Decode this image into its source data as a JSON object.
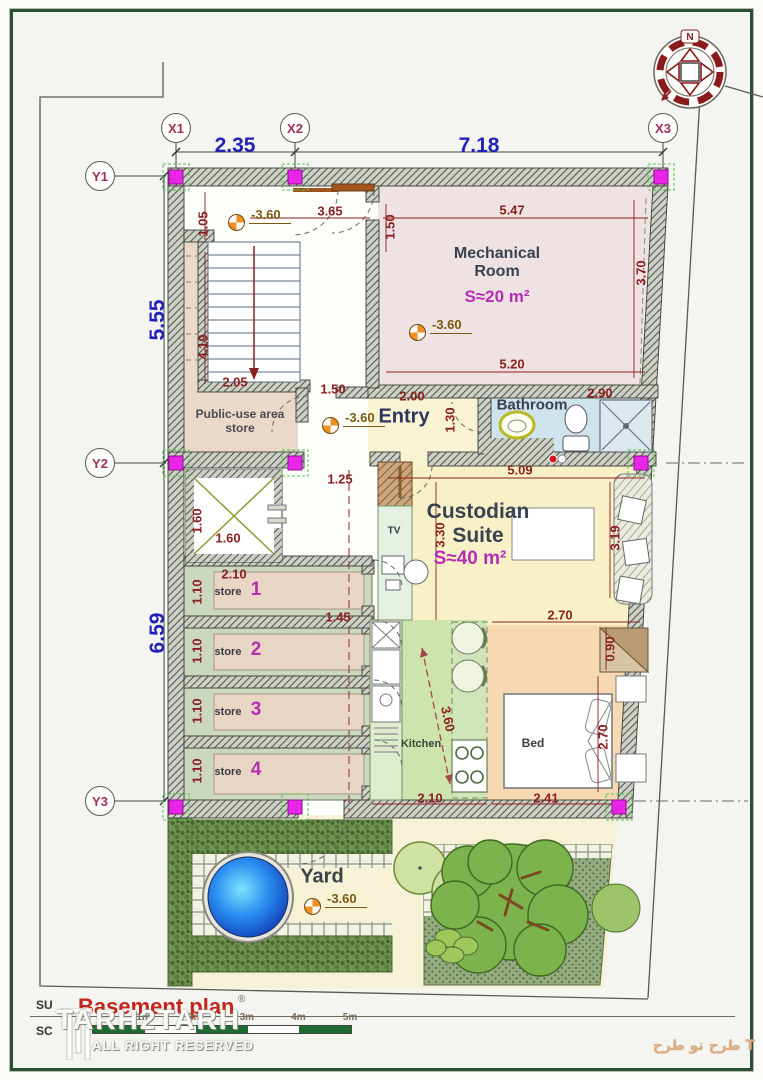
{
  "accent_colors": {
    "wall_hatch": "#4e5248",
    "column_magenta": "#ea25ea",
    "dim_red": "#8b2020",
    "dim_blue": "#2222b8",
    "area_magenta": "#b52cb5",
    "title_red": "#c2251c",
    "pool_blue": "#1560e8",
    "lawn_green": "#93ab7e"
  },
  "compass": {
    "north_label": "N"
  },
  "grid_bubbles": [
    {
      "label": "X1",
      "x": 176,
      "y": 128
    },
    {
      "label": "X2",
      "x": 295,
      "y": 128
    },
    {
      "label": "X3",
      "x": 663,
      "y": 128
    },
    {
      "label": "Y1",
      "x": 100,
      "y": 176
    },
    {
      "label": "Y2",
      "x": 100,
      "y": 463
    },
    {
      "label": "Y3",
      "x": 100,
      "y": 801
    }
  ],
  "blue_dims": [
    {
      "text": "2.35",
      "x": 235,
      "y": 146,
      "rot": 0
    },
    {
      "text": "7.18",
      "x": 479,
      "y": 146,
      "rot": 0
    },
    {
      "text": "5.55",
      "x": 158,
      "y": 320,
      "rot": -90
    },
    {
      "text": "6.59",
      "x": 158,
      "y": 633,
      "rot": -90
    }
  ],
  "red_dims": [
    {
      "text": "1.05",
      "x": 203,
      "y": 224,
      "rot": -90
    },
    {
      "text": "3.65",
      "x": 330,
      "y": 211,
      "rot": 0
    },
    {
      "text": "5.47",
      "x": 512,
      "y": 210,
      "rot": 0
    },
    {
      "text": "1.50",
      "x": 390,
      "y": 227,
      "rot": -90
    },
    {
      "text": "3.70",
      "x": 641,
      "y": 273,
      "rot": -90
    },
    {
      "text": "4.19",
      "x": 203,
      "y": 347,
      "rot": -90
    },
    {
      "text": "2.05",
      "x": 235,
      "y": 382,
      "rot": 0
    },
    {
      "text": "1.50",
      "x": 333,
      "y": 389,
      "rot": 0
    },
    {
      "text": "5.20",
      "x": 512,
      "y": 364,
      "rot": 0
    },
    {
      "text": "2.00",
      "x": 412,
      "y": 396,
      "rot": 0
    },
    {
      "text": "2.90",
      "x": 600,
      "y": 393,
      "rot": 0
    },
    {
      "text": "1.30",
      "x": 450,
      "y": 420,
      "rot": -90
    },
    {
      "text": "5.09",
      "x": 520,
      "y": 470,
      "rot": 0
    },
    {
      "text": "1.25",
      "x": 340,
      "y": 479,
      "rot": 0
    },
    {
      "text": "1.60",
      "x": 197,
      "y": 521,
      "rot": -90
    },
    {
      "text": "1.60",
      "x": 228,
      "y": 538,
      "rot": 0
    },
    {
      "text": "3.30",
      "x": 440,
      "y": 535,
      "rot": -90
    },
    {
      "text": "3.19",
      "x": 615,
      "y": 538,
      "rot": -90
    },
    {
      "text": "2.10",
      "x": 234,
      "y": 574,
      "rot": 0
    },
    {
      "text": "1.10",
      "x": 197,
      "y": 592,
      "rot": -90
    },
    {
      "text": "1.45",
      "x": 338,
      "y": 617,
      "rot": 0
    },
    {
      "text": "1.10",
      "x": 197,
      "y": 651,
      "rot": -90
    },
    {
      "text": "1.10",
      "x": 197,
      "y": 711,
      "rot": -90
    },
    {
      "text": "1.10",
      "x": 197,
      "y": 771,
      "rot": -90
    },
    {
      "text": "2.70",
      "x": 560,
      "y": 615,
      "rot": 0
    },
    {
      "text": "0.90",
      "x": 610,
      "y": 649,
      "rot": -90
    },
    {
      "text": "3.60",
      "x": 448,
      "y": 719,
      "rot": 78
    },
    {
      "text": "2.70",
      "x": 603,
      "y": 737,
      "rot": -90
    },
    {
      "text": "2.10",
      "x": 430,
      "y": 798,
      "rot": 0
    },
    {
      "text": "2.41",
      "x": 546,
      "y": 798,
      "rot": 0
    }
  ],
  "level_markers": [
    {
      "text": "-3.60",
      "x": 237,
      "y": 223
    },
    {
      "text": "-3.60",
      "x": 331,
      "y": 426
    },
    {
      "text": "-3.60",
      "x": 418,
      "y": 333
    },
    {
      "text": "-3.60",
      "x": 313,
      "y": 907
    }
  ],
  "room_labels": [
    {
      "id": "mechanical-room-label",
      "text": "Mechanical\nRoom",
      "x": 497,
      "y": 263,
      "size": 16,
      "color": "#3a4152",
      "weight": 700,
      "rot": 0
    },
    {
      "id": "mechanical-room-area",
      "text": "S≈20 m²",
      "x": 497,
      "y": 297,
      "size": 17,
      "color": "#b52cb5",
      "weight": 700,
      "rot": 0
    },
    {
      "id": "entry-label",
      "text": "Entry",
      "x": 404,
      "y": 417,
      "size": 20,
      "color": "#2c3660",
      "weight": 700,
      "rot": 0
    },
    {
      "id": "bathroom-label",
      "text": "Bathroom",
      "x": 532,
      "y": 405,
      "size": 15,
      "color": "#3a4152",
      "weight": 700,
      "rot": 0
    },
    {
      "id": "custodian-suite-label",
      "text": "Custodian\nSuite",
      "x": 478,
      "y": 524,
      "size": 21,
      "color": "#3a4152",
      "weight": 700,
      "rot": 0
    },
    {
      "id": "custodian-suite-area",
      "text": "S≈40 m²",
      "x": 470,
      "y": 559,
      "size": 19,
      "color": "#b52cb5",
      "weight": 700,
      "rot": 0
    },
    {
      "id": "public-store-label",
      "text": "Public-use area\nstore",
      "x": 240,
      "y": 421,
      "size": 12,
      "color": "#4a4a55",
      "weight": 700,
      "rot": 0
    },
    {
      "id": "store-1-label",
      "text": "store",
      "x": 228,
      "y": 592,
      "size": 11,
      "color": "#3a3a46",
      "weight": 700,
      "rot": 0
    },
    {
      "id": "store-1-num",
      "text": "1",
      "x": 256,
      "y": 590,
      "size": 19,
      "color": "#b030b0",
      "weight": 700,
      "rot": 0
    },
    {
      "id": "store-2-label",
      "text": "store",
      "x": 228,
      "y": 652,
      "size": 11,
      "color": "#3a3a46",
      "weight": 700,
      "rot": 0
    },
    {
      "id": "store-2-num",
      "text": "2",
      "x": 256,
      "y": 650,
      "size": 19,
      "color": "#b030b0",
      "weight": 700,
      "rot": 0
    },
    {
      "id": "store-3-label",
      "text": "store",
      "x": 228,
      "y": 712,
      "size": 11,
      "color": "#3a3a46",
      "weight": 700,
      "rot": 0
    },
    {
      "id": "store-3-num",
      "text": "3",
      "x": 256,
      "y": 710,
      "size": 19,
      "color": "#b030b0",
      "weight": 700,
      "rot": 0
    },
    {
      "id": "store-4-label",
      "text": "store",
      "x": 228,
      "y": 772,
      "size": 11,
      "color": "#3a3a46",
      "weight": 700,
      "rot": 0
    },
    {
      "id": "store-4-num",
      "text": "4",
      "x": 256,
      "y": 770,
      "size": 19,
      "color": "#b030b0",
      "weight": 700,
      "rot": 0
    },
    {
      "id": "tv-label",
      "text": "TV",
      "x": 394,
      "y": 531,
      "size": 10,
      "color": "#3a3a46",
      "weight": 700,
      "rot": 0
    },
    {
      "id": "kitchen-label",
      "text": "Kitchen",
      "x": 421,
      "y": 744,
      "size": 11,
      "color": "#3a4435",
      "weight": 700,
      "rot": 0
    },
    {
      "id": "bed-label",
      "text": "Bed",
      "x": 533,
      "y": 743,
      "size": 12,
      "color": "#3a3f46",
      "weight": 700,
      "rot": 0
    },
    {
      "id": "yard-label",
      "text": "Yard",
      "x": 322,
      "y": 877,
      "size": 20,
      "color": "#3a4248",
      "weight": 700,
      "rot": 0
    }
  ],
  "title_block": {
    "left_top": "SU",
    "left_bottom": "SC",
    "title": "Basement plan",
    "reg_mark": "®",
    "scale_labels": [
      "1m",
      "2m",
      "3m",
      "4m",
      "5m"
    ]
  },
  "watermark": {
    "name": "TARH2TARH",
    "sub": "ALL RIGHT RESERVED"
  },
  "footer_brand_fa": "طرح تو طرح  T"
}
